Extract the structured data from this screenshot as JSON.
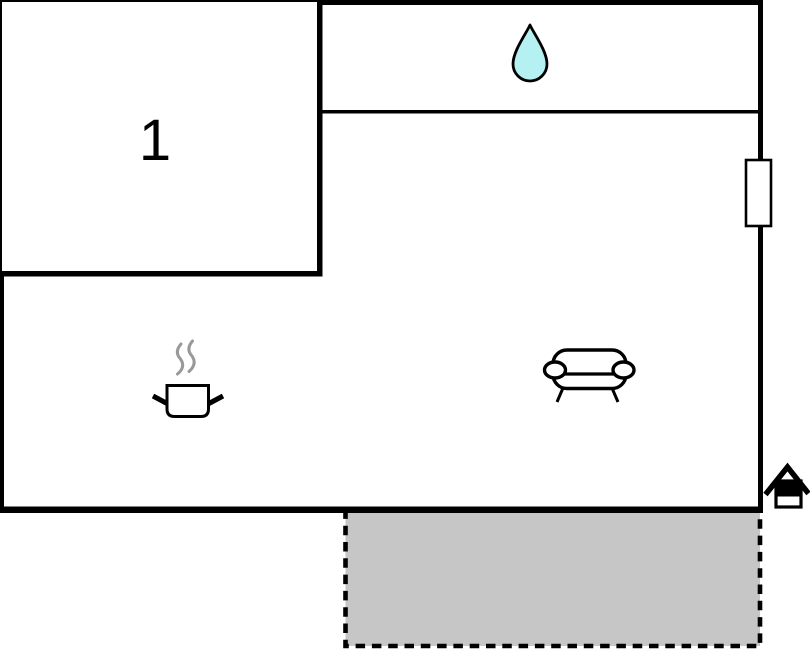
{
  "floorplan": {
    "rooms": [
      {
        "label": "1",
        "type": "room"
      }
    ],
    "colors": {
      "wall": "#000000",
      "background": "#ffffff",
      "water_drop_fill": "#b5f1f3",
      "terrace_fill": "#c6c6c6",
      "steam": "#999999"
    },
    "icons": [
      "water-drop-icon",
      "window",
      "cooking-pot-icon",
      "steam-icon",
      "sofa-icon",
      "house-entrance-icon",
      "terrace"
    ]
  }
}
